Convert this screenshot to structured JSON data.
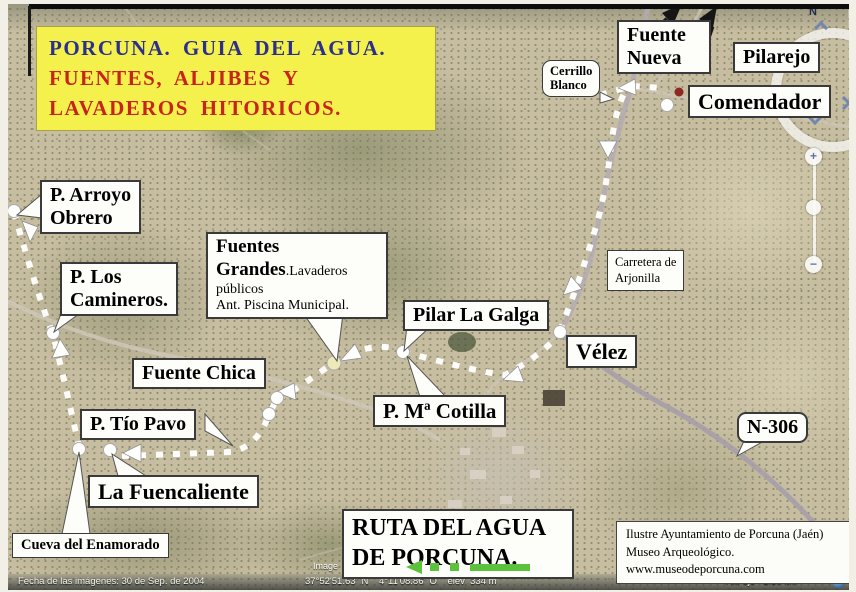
{
  "title_box": {
    "line1": "PORCUNA. GUIA DEL AGUA.",
    "line2": "FUENTES, ALJIBES Y",
    "line3": "LAVADEROS HITORICOS."
  },
  "labels": {
    "fuente_nueva_line1": "Fuente",
    "fuente_nueva_line2": "Nueva",
    "pilarejo": "Pilarejo",
    "cerrillo_line1": "Cerrillo",
    "cerrillo_line2": "Blanco",
    "comendador": "Comendador",
    "arroyo_line1": "P. Arroyo",
    "arroyo_line2": "Obrero",
    "camineros_line1": "P. Los",
    "camineros_line2": "Camineros.",
    "fuentes_grandes_bold1": "Fuentes",
    "fuentes_grandes_bold2": "Grandes",
    "fuentes_grandes_rest": ".Lavaderos",
    "fuentes_grandes_line3": "públicos",
    "fuentes_grandes_line4": "Ant. Piscina Municipal.",
    "pilar_la_galga": "Pilar La Galga",
    "carretera_line1": "Carretera de",
    "carretera_line2": "Arjonilla",
    "velez": "Vélez",
    "fuente_chica": "Fuente Chica",
    "ma_cotilla": "P. Mª Cotilla",
    "tio_pavo": "P. Tío Pavo",
    "fuencaliente": "La Fuencaliente",
    "cueva": "Cueva del Enamorado",
    "n306": "N-306"
  },
  "ruta_box": {
    "line1": "RUTA DEL AGUA",
    "line2": "DE PORCUNA."
  },
  "credit_box": {
    "line1": "Ilustre Ayuntamiento de Porcuna (Jaén)",
    "line2": "Museo Arqueológico.",
    "line3": "www.museodeporcuna.com"
  },
  "status_bar": {
    "fecha": "Fecha de las imágenes: 30 de Sep. de 2004",
    "image_attrib": "Image",
    "coords": "37°52'51.63\" N    4°11'08.86\" O    elev  334 m",
    "eye_alt": "Alt. ojo   2.59 km"
  },
  "controls": {
    "north_label": "N",
    "zoom_in_label": "+",
    "zoom_out_label": "−"
  },
  "colors": {
    "title_bg": "#f5f14c",
    "title_blue": "#2b2f8e",
    "title_red": "#c8241e",
    "route_white": "#ffffff",
    "green_arrow": "#5cc23e",
    "red_dot": "#8e2822",
    "control_blue": "#7288ae"
  }
}
